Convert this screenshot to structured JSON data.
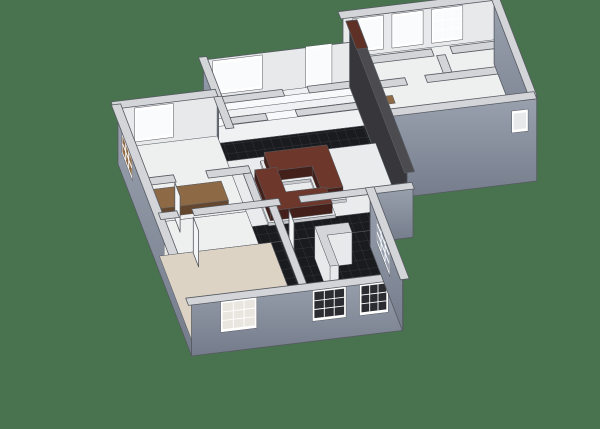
{
  "meta": {
    "label": "3D isometric floor plan rendering of a two-unit apartment with gray exterior walls, dark tile floors, beige carpet bedroom, wood kitchen counter and maroon sectional sofas on a green background",
    "canvas": {
      "width": 600,
      "height": 429
    }
  },
  "palette": {
    "bg": "#48734e",
    "extHi": "#9aa2b0",
    "extLo": "#747b8a",
    "innerFace": "#e7e9eb",
    "winFrame": "#ffffff",
    "winBright": "#fafbfc",
    "winPane": "#97a0ae",
    "winDark": "#2a2c31",
    "winLattice": "#e9e6df",
    "wallTop": "#d3d5d8",
    "edge": "#565a61",
    "floorWhite": "#eef0f0",
    "livFloor": "#e9ebec",
    "bed1Floor": "#f0f1f2",
    "bed1Stripe": "#f8f9fa",
    "tileBase": "#1a1b1e",
    "tileLine": "#393c41",
    "tileDark": "#232529",
    "carpet": "#dcd3c5",
    "wood": "#8d6a45",
    "woodTop": "#8d6a45",
    "woodSide": "#64472c",
    "sofaTop": "#6d382b",
    "sofaSide": "#44201a",
    "sofaBase": "#e9eaeb",
    "sofaBaseSide": "#c7c9cc",
    "charTop": "#4b4b50",
    "charFace": "#37373b",
    "beamBrown": "#5e3026",
    "doorWhite": "#f3f4f5"
  },
  "projection": {
    "ox": 118,
    "oy": 148,
    "ex": 12.4,
    "ey": -1.5,
    "sx": 4.6,
    "sy": 12.0,
    "wall_h": 40,
    "ext_drop": 16
  },
  "scene": [
    {
      "n": "unitB-far-wall-face",
      "k": "face",
      "at": [
        20,
        -5
      ],
      "dir": "E",
      "len": 12.35,
      "ztop": -40,
      "zbot": 2,
      "f": "innerFace"
    },
    {
      "n": "unitB-window-1",
      "k": "window",
      "at": [
        20,
        -5
      ],
      "dir": "E",
      "t1": 0.9,
      "t2": 3.1,
      "z1": -35,
      "z2": -7,
      "pane": "winBright"
    },
    {
      "n": "unitB-window-2",
      "k": "window",
      "at": [
        20,
        -5
      ],
      "dir": "E",
      "t1": 4.1,
      "t2": 6.3,
      "z1": -35,
      "z2": -7,
      "pane": "winBright"
    },
    {
      "n": "unitB-window-3",
      "k": "window",
      "at": [
        20,
        -5
      ],
      "dir": "E",
      "t1": 7.3,
      "t2": 9.5,
      "z1": -35,
      "z2": -7,
      "pane": "winBright",
      "grid": true
    },
    {
      "n": "unitB-floor",
      "k": "floor",
      "rect": [
        20,
        -5,
        32.3,
        3
      ],
      "f": "floorWhite"
    },
    {
      "n": "unitB-tile-strip",
      "k": "floor",
      "rect": [
        20.3,
        0.9,
        24.6,
        2.7
      ],
      "f": "tilePat"
    },
    {
      "n": "unitB-dresser",
      "k": "floor",
      "rect": [
        26.6,
        2.1,
        29.6,
        2.95
      ],
      "f": "tileDark"
    },
    {
      "n": "unitB-door-wood-1",
      "k": "floor",
      "rect": [
        21.0,
        -1.55,
        22.7,
        -0.9
      ],
      "f": "wood"
    },
    {
      "n": "unitB-door-wood-2",
      "k": "floor",
      "rect": [
        23.4,
        1.0,
        24.9,
        1.6
      ],
      "f": "wood"
    },
    {
      "n": "unitB-wall-top-1a",
      "k": "strip",
      "rect": [
        20,
        -1.7,
        25.9,
        -1.1
      ]
    },
    {
      "n": "unitB-wall-top-1b",
      "k": "strip",
      "rect": [
        27.4,
        -1.7,
        32.3,
        -1.1
      ]
    },
    {
      "n": "unitB-wall-top-2a",
      "k": "strip",
      "rect": [
        20,
        0.35,
        23.0,
        0.95
      ]
    },
    {
      "n": "unitB-wall-top-2b",
      "k": "strip",
      "rect": [
        24.6,
        0.35,
        32.3,
        0.95
      ]
    },
    {
      "n": "unitB-wall-top-mid",
      "k": "strip",
      "rect": [
        26.1,
        -1.1,
        26.8,
        0.35
      ]
    },
    {
      "n": "unitB-north-wall-top",
      "k": "strip",
      "rect": [
        19.8,
        -5.55,
        32.4,
        -4.95
      ]
    },
    {
      "n": "unitB-east-wall-face",
      "k": "face",
      "at": [
        32.3,
        -5.3
      ],
      "dir": "S",
      "len": 8.4,
      "ztop": -40,
      "zbot": 28,
      "f": "extGrad"
    },
    {
      "n": "unitB-east-wall-top",
      "k": "strip",
      "rect": [
        32.0,
        -5.4,
        32.65,
        3.15
      ]
    },
    {
      "n": "unitB-south-wall-face",
      "k": "face",
      "at": [
        19.9,
        3
      ],
      "dir": "E",
      "len": 12.75,
      "ztop": -40,
      "zbot": 46,
      "f": "extGrad"
    },
    {
      "n": "unitB-south-notch",
      "k": "window",
      "at": [
        19.9,
        3
      ],
      "dir": "E",
      "t1": 10.9,
      "t2": 11.9,
      "z1": -24,
      "z2": -8,
      "pane": "innerFace"
    },
    {
      "n": "unitB-south-wall-top",
      "k": "strip",
      "rect": [
        19.8,
        2.7,
        32.55,
        3.3
      ]
    },
    {
      "n": "bedroom1-far-wall-face",
      "k": "face",
      "at": [
        8,
        -3
      ],
      "dir": "E",
      "len": 11.9,
      "ztop": -40,
      "zbot": 2,
      "f": "innerFace"
    },
    {
      "n": "bedroom1-window",
      "k": "window",
      "at": [
        8,
        -3
      ],
      "dir": "E",
      "t1": 0.9,
      "t2": 4.6,
      "z1": -35,
      "z2": -7,
      "pane": "winBright"
    },
    {
      "n": "bedroom1-door",
      "k": "window",
      "at": [
        8,
        -3
      ],
      "dir": "E",
      "t1": 8.4,
      "t2": 10.2,
      "z1": -38,
      "z2": -2,
      "pane": "winBright"
    },
    {
      "n": "bedroom1-floor",
      "k": "floor",
      "rect": [
        8,
        -3,
        20,
        0.6
      ],
      "f": "bed1Floor"
    },
    {
      "n": "bedroom1-floor-stripe-1",
      "k": "floor",
      "rect": [
        8,
        -2.55,
        20,
        -1.95
      ],
      "f": "bed1Stripe"
    },
    {
      "n": "bedroom1-floor-stripe-2",
      "k": "floor",
      "rect": [
        8,
        -1.35,
        20,
        -0.75
      ],
      "f": "bed1Stripe"
    },
    {
      "n": "hallway-tile-floor",
      "k": "floor",
      "rect": [
        8,
        0.6,
        20,
        2.1
      ],
      "f": "tilePat"
    },
    {
      "n": "bedroom1-west-wall-face",
      "k": "face",
      "at": [
        8,
        -3
      ],
      "dir": "S",
      "len": 3.3,
      "ztop": -40,
      "zbot": 8,
      "f": "extGrad"
    },
    {
      "n": "bedroom1-west-wall-top",
      "k": "strip",
      "rect": [
        7.7,
        -3.25,
        8.35,
        0.1
      ]
    },
    {
      "n": "bedroom1-south-wall-top-a",
      "k": "strip",
      "rect": [
        8,
        0.1,
        13.2,
        0.65
      ]
    },
    {
      "n": "bedroom1-south-wall-top-b",
      "k": "strip",
      "rect": [
        15.2,
        0.1,
        20,
        0.65
      ]
    },
    {
      "n": "hallway-south-wall-top-a",
      "k": "strip",
      "rect": [
        8,
        1.85,
        11.2,
        2.4
      ]
    },
    {
      "n": "hallway-south-wall-top-b",
      "k": "strip",
      "rect": [
        13.6,
        1.85,
        20,
        2.4
      ]
    },
    {
      "n": "divider-wall-face",
      "k": "face",
      "at": [
        19.9,
        -3.3
      ],
      "dir": "S",
      "len": 12.5,
      "ztop": -56,
      "zbot": 8,
      "f": "charFace"
    },
    {
      "n": "divider-wall-top",
      "k": "strip",
      "rect": [
        19.7,
        -3.4,
        20.5,
        9.2
      ],
      "h": 56,
      "f": "charTop"
    },
    {
      "n": "divider-wall-beam",
      "k": "strip",
      "rect": [
        19.65,
        -3.45,
        20.55,
        -1.1
      ],
      "h": 56,
      "f": "beamBrown"
    },
    {
      "n": "kitchen-far-wall-face",
      "k": "face",
      "at": [
        0,
        0
      ],
      "dir": "E",
      "len": 8,
      "ztop": -40,
      "zbot": 2,
      "f": "innerFace"
    },
    {
      "n": "kitchen-window",
      "k": "window",
      "at": [
        0,
        0
      ],
      "dir": "E",
      "t1": 1.5,
      "t2": 4.3,
      "z1": -35,
      "z2": -7,
      "pane": "winBright"
    },
    {
      "n": "kitchen-floor",
      "k": "floor",
      "rect": [
        0,
        0,
        8,
        6.3
      ],
      "f": "floorWhite"
    },
    {
      "n": "kitchen-counter",
      "k": "box",
      "poly": [
        [
          0.35,
          4.35
        ],
        [
          6.7,
          4.35
        ],
        [
          6.7,
          5.95
        ],
        [
          0.35,
          5.95
        ]
      ],
      "lift": 9,
      "top": "woodTop",
      "side": "woodSide"
    },
    {
      "n": "kitchen-north-wall-top",
      "k": "strip",
      "rect": [
        -0.35,
        -0.55,
        8.05,
        0.05
      ]
    },
    {
      "n": "kitchen-east-wall-top-a",
      "k": "strip",
      "rect": [
        7.7,
        0.05,
        8.35,
        2.7
      ]
    },
    {
      "n": "kitchen-east-wall-top-b",
      "k": "strip",
      "rect": [
        7.7,
        5.3,
        8.35,
        6.5
      ]
    },
    {
      "n": "living-floor",
      "k": "floor",
      "rect": [
        8,
        2.1,
        20,
        9
      ],
      "f": "livFloor"
    },
    {
      "n": "living-tile-band",
      "k": "floor",
      "rect": [
        8,
        7.55,
        20,
        9
      ],
      "f": "tilePat"
    },
    {
      "n": "sofa-1-base",
      "k": "box",
      "poly": [
        [
          10.5,
          2.65
        ],
        [
          16.0,
          2.65
        ],
        [
          16.0,
          6.5
        ],
        [
          13.85,
          6.5
        ],
        [
          13.85,
          4.55
        ],
        [
          10.5,
          4.55
        ]
      ],
      "lift": 3,
      "top": "sofaBase",
      "side": "sofaBaseSide"
    },
    {
      "n": "sofa-1",
      "k": "box",
      "poly": [
        [
          10.75,
          2.8
        ],
        [
          15.8,
          2.8
        ],
        [
          15.8,
          6.3
        ],
        [
          14.05,
          6.3
        ],
        [
          14.05,
          4.35
        ],
        [
          10.75,
          4.35
        ]
      ],
      "lift": 13,
      "baseLift": 3,
      "top": "sofaTop",
      "side": "sofaSide"
    },
    {
      "n": "sofa-2-base",
      "k": "box",
      "poly": [
        [
          9.3,
          3.95
        ],
        [
          11.45,
          3.95
        ],
        [
          11.45,
          5.95
        ],
        [
          14.7,
          5.95
        ],
        [
          14.7,
          7.65
        ],
        [
          9.3,
          7.65
        ]
      ],
      "lift": 3,
      "top": "sofaBase",
      "side": "sofaBaseSide"
    },
    {
      "n": "sofa-2",
      "k": "box",
      "poly": [
        [
          9.5,
          4.1
        ],
        [
          11.25,
          4.1
        ],
        [
          11.25,
          6.15
        ],
        [
          14.5,
          6.15
        ],
        [
          14.5,
          7.5
        ],
        [
          9.5,
          7.5
        ]
      ],
      "lift": 13,
      "baseLift": 3,
      "top": "sofaTop",
      "side": "sofaSide"
    },
    {
      "n": "living-south-wall-face",
      "k": "face",
      "at": [
        17,
        9
      ],
      "dir": "E",
      "len": 3.45,
      "ztop": -40,
      "zbot": 12,
      "f": "extGrad"
    },
    {
      "n": "living-south-wall-top",
      "k": "strip",
      "rect": [
        17,
        8.75,
        20.45,
        9.3
      ]
    },
    {
      "n": "hall-floor",
      "k": "floor",
      "rect": [
        0,
        6.3,
        8,
        9
      ],
      "f": "floorWhite"
    },
    {
      "n": "hall-north-wall-top-a",
      "k": "strip",
      "rect": [
        0,
        5.85,
        2.3,
        6.45
      ]
    },
    {
      "n": "hall-north-wall-top-b",
      "k": "strip",
      "rect": [
        4.9,
        5.85,
        8.35,
        6.45
      ]
    },
    {
      "n": "hall-door-leaf",
      "k": "face",
      "at": [
        2.3,
        6.15
      ],
      "dir": "S",
      "len": 1.15,
      "ztop": -36,
      "zbot": 0,
      "f": "doorWhite"
    },
    {
      "n": "hall-east-wall-top",
      "k": "strip",
      "rect": [
        7.7,
        6.45,
        8.35,
        9.0
      ]
    },
    {
      "n": "west-wall-face",
      "k": "face",
      "at": [
        0,
        0
      ],
      "dir": "S",
      "len": 16,
      "ztop": -40,
      "zbot": 16,
      "f": "extGrad"
    },
    {
      "n": "west-window-1",
      "k": "window",
      "at": [
        0,
        0
      ],
      "dir": "S",
      "t1": 1.0,
      "t2": 3.0,
      "z1": -33,
      "z2": -8,
      "pane": "woodTop",
      "grid": true
    },
    {
      "n": "west-window-2",
      "k": "window",
      "at": [
        0,
        0
      ],
      "dir": "S",
      "t1": 10.2,
      "t2": 13.0,
      "z1": -33,
      "z2": -8,
      "pane": "winLattice",
      "grid": true
    },
    {
      "n": "west-wall-top",
      "k": "strip",
      "rect": [
        -0.42,
        -0.3,
        0.32,
        16.4
      ]
    },
    {
      "n": "bedroom2-floor",
      "k": "floor",
      "rect": [
        0,
        9,
        9,
        16
      ],
      "f": "carpet"
    },
    {
      "n": "bath-floor",
      "k": "floor",
      "rect": [
        9,
        9,
        17,
        16
      ],
      "f": "tilePat"
    },
    {
      "n": "bath-inner-block",
      "k": "box",
      "poly": [
        [
          11.9,
          10.7
        ],
        [
          14.6,
          10.7
        ],
        [
          14.6,
          11.5
        ],
        [
          12.6,
          11.5
        ],
        [
          12.6,
          14.0
        ],
        [
          11.9,
          14.0
        ]
      ],
      "lift": 32,
      "top": "wallTop",
      "side": "innerFace"
    },
    {
      "n": "bedroom2-north-wall-top-a",
      "k": "strip",
      "rect": [
        0,
        8.75,
        1.5,
        9.3
      ]
    },
    {
      "n": "bedroom2-north-wall-top-b",
      "k": "strip",
      "rect": [
        2.7,
        8.75,
        9.7,
        9.3
      ]
    },
    {
      "n": "bedroom2-north-wall-top-c",
      "k": "strip",
      "rect": [
        11.3,
        8.75,
        17.3,
        9.3
      ]
    },
    {
      "n": "bedroom2-door-leaf",
      "k": "face",
      "at": [
        2.7,
        9.1
      ],
      "dir": "S",
      "len": 1.15,
      "ztop": -36,
      "zbot": 0,
      "f": "doorWhite"
    },
    {
      "n": "bath-door-leaf",
      "k": "face",
      "at": [
        10.3,
        9.4
      ],
      "dir": "S",
      "len": 1.1,
      "ztop": -36,
      "zbot": 0,
      "f": "doorWhite"
    },
    {
      "n": "bedroom2-east-wall-top",
      "k": "strip",
      "rect": [
        8.7,
        9.3,
        9.35,
        16.3
      ]
    },
    {
      "n": "south-wall-face",
      "k": "face",
      "at": [
        0,
        16
      ],
      "dir": "E",
      "len": 17.05,
      "ztop": -40,
      "zbot": 16,
      "f": "extGrad"
    },
    {
      "n": "south-window-1",
      "k": "window",
      "at": [
        0,
        16
      ],
      "dir": "E",
      "t1": 2.5,
      "t2": 5.1,
      "z1": -33,
      "z2": -7,
      "pane": "winLattice",
      "grid": true
    },
    {
      "n": "south-window-2",
      "k": "window",
      "at": [
        0,
        16
      ],
      "dir": "E",
      "t1": 9.9,
      "t2": 12.3,
      "z1": -33,
      "z2": -7,
      "pane": "winDark",
      "grid": true
    },
    {
      "n": "south-window-3",
      "k": "window",
      "at": [
        0,
        16
      ],
      "dir": "E",
      "t1": 13.7,
      "t2": 15.7,
      "z1": -33,
      "z2": -7,
      "pane": "winDark",
      "grid": true
    },
    {
      "n": "south-wall-top",
      "k": "strip",
      "rect": [
        -0.4,
        15.8,
        17.4,
        16.4
      ]
    },
    {
      "n": "east-wall-face",
      "k": "face",
      "at": [
        17,
        9
      ],
      "dir": "S",
      "len": 7.05,
      "ztop": -40,
      "zbot": 16,
      "f": "extGrad"
    },
    {
      "n": "east-window",
      "k": "window",
      "at": [
        17,
        9
      ],
      "dir": "S",
      "t1": 1.5,
      "t2": 4.1,
      "z1": -33,
      "z2": -8,
      "pane": "winPane",
      "grid": true
    },
    {
      "n": "east-wall-top",
      "k": "strip",
      "rect": [
        16.7,
        8.75,
        17.4,
        16.4
      ]
    }
  ]
}
